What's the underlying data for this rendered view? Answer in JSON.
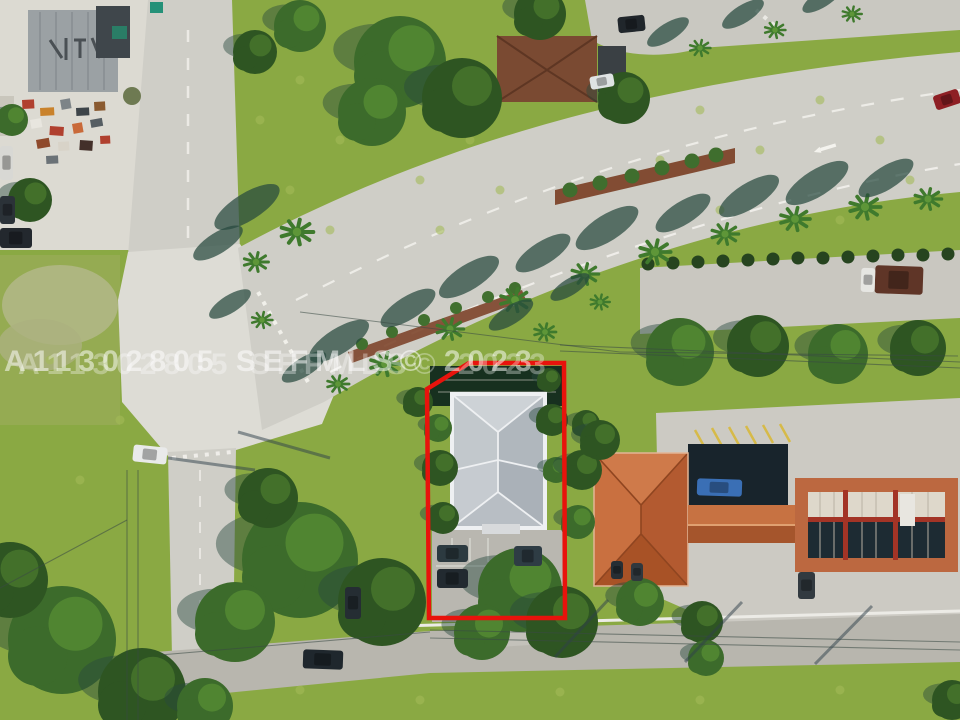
{
  "image": {
    "kind": "aerial-drone-photo",
    "subject": "real-estate parcel outlined in red at a palm-lined boulevard intersection"
  },
  "watermark": {
    "text": "A11302805 SEFMLS© 2023",
    "color": "rgba(255,255,255,0.52)",
    "ghost_color": "rgba(255,255,255,0.33)"
  },
  "property_outline": {
    "points": "427,389 469,363 564,363 565,618 429,618",
    "color": "#e8130c"
  },
  "colors": {
    "grass": "#8aa943",
    "grass_light": "#a3bb58",
    "road": "#cfcec7",
    "road_bottom": "#b8b6ae",
    "concrete": "#dcdad2",
    "house_roof": "#bcc2c7",
    "orange_roof": "#c06a3e",
    "dark_roof": "#18242c",
    "shadow": "#27493f",
    "mulch": "#7d452b",
    "canopy_dark": "#33592a"
  },
  "scene": {
    "palms": [
      {
        "x": 385,
        "y": 364,
        "s": 1.15
      },
      {
        "x": 450,
        "y": 329,
        "s": 1.05
      },
      {
        "x": 515,
        "y": 300,
        "s": 1.15
      },
      {
        "x": 585,
        "y": 274,
        "s": 1.05
      },
      {
        "x": 655,
        "y": 252,
        "s": 1.2
      },
      {
        "x": 725,
        "y": 234,
        "s": 1.05
      },
      {
        "x": 795,
        "y": 219,
        "s": 1.15
      },
      {
        "x": 865,
        "y": 207,
        "s": 1.2
      },
      {
        "x": 928,
        "y": 199,
        "s": 1.05
      },
      {
        "x": 700,
        "y": 48,
        "s": 0.8
      },
      {
        "x": 775,
        "y": 30,
        "s": 0.8
      },
      {
        "x": 852,
        "y": 14,
        "s": 0.75
      },
      {
        "x": 297,
        "y": 232,
        "s": 1.25
      },
      {
        "x": 256,
        "y": 262,
        "s": 0.95
      },
      {
        "x": 338,
        "y": 384,
        "s": 0.85
      },
      {
        "x": 545,
        "y": 332,
        "s": 0.85
      },
      {
        "x": 600,
        "y": 302,
        "s": 0.75
      },
      {
        "x": 262,
        "y": 320,
        "s": 0.8
      }
    ],
    "median_bushes": [
      {
        "x": 570,
        "y": 190
      },
      {
        "x": 600,
        "y": 183
      },
      {
        "x": 632,
        "y": 176
      },
      {
        "x": 662,
        "y": 168
      },
      {
        "x": 692,
        "y": 161
      },
      {
        "x": 716,
        "y": 155
      }
    ],
    "verge_bushes": [
      {
        "x": 362,
        "y": 344
      },
      {
        "x": 392,
        "y": 332
      },
      {
        "x": 424,
        "y": 320
      },
      {
        "x": 456,
        "y": 308
      },
      {
        "x": 488,
        "y": 297
      },
      {
        "x": 515,
        "y": 288
      }
    ],
    "hedge_row": [
      {
        "x": 648,
        "y": 264
      },
      {
        "x": 673,
        "y": 263
      },
      {
        "x": 698,
        "y": 262
      },
      {
        "x": 723,
        "y": 261
      },
      {
        "x": 748,
        "y": 260
      },
      {
        "x": 773,
        "y": 259
      },
      {
        "x": 798,
        "y": 258
      },
      {
        "x": 823,
        "y": 258
      },
      {
        "x": 848,
        "y": 257
      },
      {
        "x": 873,
        "y": 256
      },
      {
        "x": 898,
        "y": 255
      },
      {
        "x": 923,
        "y": 255
      },
      {
        "x": 948,
        "y": 254
      }
    ],
    "tree_clumps": [
      {
        "x": 400,
        "y": 62,
        "r": 46,
        "t": 0
      },
      {
        "x": 462,
        "y": 98,
        "r": 40,
        "t": 1
      },
      {
        "x": 372,
        "y": 112,
        "r": 34,
        "t": 0
      },
      {
        "x": 540,
        "y": 14,
        "r": 26,
        "t": 1
      },
      {
        "x": 624,
        "y": 98,
        "r": 26,
        "t": 1
      },
      {
        "x": 300,
        "y": 26,
        "r": 26,
        "t": 0
      },
      {
        "x": 255,
        "y": 52,
        "r": 22,
        "t": 1
      },
      {
        "x": 300,
        "y": 560,
        "r": 58,
        "t": 0
      },
      {
        "x": 382,
        "y": 602,
        "r": 44,
        "t": 1
      },
      {
        "x": 235,
        "y": 622,
        "r": 40,
        "t": 0
      },
      {
        "x": 268,
        "y": 498,
        "r": 30,
        "t": 1
      },
      {
        "x": 62,
        "y": 640,
        "r": 54,
        "t": 0
      },
      {
        "x": 142,
        "y": 692,
        "r": 44,
        "t": 1
      },
      {
        "x": 10,
        "y": 580,
        "r": 38,
        "t": 1
      },
      {
        "x": 205,
        "y": 706,
        "r": 28,
        "t": 0
      },
      {
        "x": 440,
        "y": 468,
        "r": 18,
        "t": 1
      },
      {
        "x": 438,
        "y": 428,
        "r": 14,
        "t": 0
      },
      {
        "x": 443,
        "y": 518,
        "r": 16,
        "t": 1
      },
      {
        "x": 552,
        "y": 420,
        "r": 16,
        "t": 1
      },
      {
        "x": 556,
        "y": 470,
        "r": 13,
        "t": 0
      },
      {
        "x": 549,
        "y": 380,
        "r": 12,
        "t": 1
      },
      {
        "x": 418,
        "y": 402,
        "r": 15,
        "t": 1
      },
      {
        "x": 520,
        "y": 590,
        "r": 42,
        "t": 0
      },
      {
        "x": 562,
        "y": 622,
        "r": 36,
        "t": 1
      },
      {
        "x": 482,
        "y": 632,
        "r": 28,
        "t": 0
      },
      {
        "x": 582,
        "y": 470,
        "r": 20,
        "t": 1
      },
      {
        "x": 578,
        "y": 522,
        "r": 17,
        "t": 0
      },
      {
        "x": 586,
        "y": 424,
        "r": 14,
        "t": 1
      },
      {
        "x": 680,
        "y": 352,
        "r": 34,
        "t": 0
      },
      {
        "x": 758,
        "y": 346,
        "r": 31,
        "t": 1
      },
      {
        "x": 838,
        "y": 354,
        "r": 30,
        "t": 0
      },
      {
        "x": 918,
        "y": 348,
        "r": 28,
        "t": 1
      },
      {
        "x": 600,
        "y": 440,
        "r": 20,
        "t": 1
      },
      {
        "x": 640,
        "y": 602,
        "r": 24,
        "t": 0
      },
      {
        "x": 702,
        "y": 622,
        "r": 21,
        "t": 1
      },
      {
        "x": 706,
        "y": 658,
        "r": 18,
        "t": 0
      },
      {
        "x": 952,
        "y": 700,
        "r": 20,
        "t": 1
      },
      {
        "x": 30,
        "y": 200,
        "r": 22,
        "t": 1
      },
      {
        "x": 12,
        "y": 120,
        "r": 16,
        "t": 0
      }
    ],
    "cars": [
      {
        "x": 618,
        "y": 16,
        "w": 27,
        "h": 16,
        "c": "#20262b",
        "rot": -6,
        "name": "suv-top"
      },
      {
        "x": 590,
        "y": 75,
        "w": 24,
        "h": 13,
        "c": "#dfe3e4",
        "rot": -10,
        "name": "white-vehicle-house"
      },
      {
        "x": 934,
        "y": 92,
        "w": 26,
        "h": 15,
        "c": "#8e1f24",
        "rot": -18,
        "name": "red-car"
      },
      {
        "x": 133,
        "y": 446,
        "w": 34,
        "h": 17,
        "c": "#e9eaea",
        "rot": 6,
        "name": "white-car-intersection"
      },
      {
        "x": 875,
        "y": 266,
        "w": 48,
        "h": 28,
        "c": "#5f3527",
        "rot": 2,
        "name": "truck-trailer"
      },
      {
        "x": 861,
        "y": 268,
        "w": 14,
        "h": 24,
        "c": "#e6e6e2",
        "rot": 2,
        "name": "truck-cab"
      },
      {
        "x": 697,
        "y": 479,
        "w": 45,
        "h": 17,
        "c": "#3a6fb5",
        "rot": 2,
        "name": "blue-pickup"
      },
      {
        "x": 798,
        "y": 572,
        "w": 17,
        "h": 27,
        "c": "#323a40",
        "rot": 0,
        "name": "gray-car-canopy"
      },
      {
        "x": 611,
        "y": 561,
        "w": 12,
        "h": 18,
        "c": "#262e34",
        "rot": 0,
        "name": "dark-car-lot-a"
      },
      {
        "x": 631,
        "y": 563,
        "w": 12,
        "h": 18,
        "c": "#30383e",
        "rot": 0,
        "name": "dark-car-lot-b"
      },
      {
        "x": 437,
        "y": 545,
        "w": 31,
        "h": 17,
        "c": "#2c3a40",
        "rot": 0,
        "name": "parked-car-1"
      },
      {
        "x": 437,
        "y": 569,
        "w": 31,
        "h": 19,
        "c": "#222a30",
        "rot": 0,
        "name": "parked-car-2"
      },
      {
        "x": 514,
        "y": 546,
        "w": 28,
        "h": 20,
        "c": "#2e3c44",
        "rot": 0,
        "name": "parked-car-3"
      },
      {
        "x": 345,
        "y": 587,
        "w": 16,
        "h": 32,
        "c": "#252d33",
        "rot": 0,
        "name": "street-car-west"
      },
      {
        "x": 303,
        "y": 650,
        "w": 40,
        "h": 19,
        "c": "#1f272d",
        "rot": 2,
        "name": "car-bottom-road"
      },
      {
        "x": 0,
        "y": 146,
        "w": 13,
        "h": 34,
        "c": "#d8d8d4",
        "rot": 0,
        "name": "white-van-yard"
      },
      {
        "x": 0,
        "y": 196,
        "w": 15,
        "h": 28,
        "c": "#2b3238",
        "rot": 0,
        "name": "dark-car-yard"
      },
      {
        "x": 0,
        "y": 228,
        "w": 32,
        "h": 20,
        "c": "#23282e",
        "rot": 0,
        "name": "truck-yard"
      }
    ],
    "junk": [
      {
        "x": 22,
        "y": 100,
        "w": 12,
        "h": 9,
        "c": "#b0402f"
      },
      {
        "x": 40,
        "y": 108,
        "w": 14,
        "h": 8,
        "c": "#c9822c"
      },
      {
        "x": 60,
        "y": 100,
        "w": 10,
        "h": 10,
        "c": "#7d8488"
      },
      {
        "x": 76,
        "y": 108,
        "w": 13,
        "h": 8,
        "c": "#3d4449"
      },
      {
        "x": 94,
        "y": 102,
        "w": 11,
        "h": 9,
        "c": "#8a5a30"
      },
      {
        "x": 30,
        "y": 120,
        "w": 11,
        "h": 9,
        "c": "#e8e6df"
      },
      {
        "x": 50,
        "y": 126,
        "w": 14,
        "h": 9,
        "c": "#b0402f"
      },
      {
        "x": 72,
        "y": 124,
        "w": 10,
        "h": 10,
        "c": "#c96a3a"
      },
      {
        "x": 90,
        "y": 120,
        "w": 12,
        "h": 8,
        "c": "#565e63"
      },
      {
        "x": 36,
        "y": 140,
        "w": 13,
        "h": 9,
        "c": "#8f4a2c"
      },
      {
        "x": 58,
        "y": 142,
        "w": 11,
        "h": 9,
        "c": "#d8d3c8"
      },
      {
        "x": 80,
        "y": 140,
        "w": 13,
        "h": 10,
        "c": "#43302a"
      },
      {
        "x": 100,
        "y": 136,
        "w": 10,
        "h": 8,
        "c": "#b0402f"
      },
      {
        "x": 46,
        "y": 156,
        "w": 12,
        "h": 8,
        "c": "#6b7277"
      }
    ],
    "speckles": [
      {
        "x": 300,
        "y": 80
      },
      {
        "x": 340,
        "y": 140
      },
      {
        "x": 290,
        "y": 190
      },
      {
        "x": 420,
        "y": 180
      },
      {
        "x": 470,
        "y": 140
      },
      {
        "x": 360,
        "y": 60
      },
      {
        "x": 440,
        "y": 230
      },
      {
        "x": 500,
        "y": 190
      },
      {
        "x": 330,
        "y": 230
      },
      {
        "x": 260,
        "y": 120
      },
      {
        "x": 700,
        "y": 110
      },
      {
        "x": 760,
        "y": 150
      },
      {
        "x": 820,
        "y": 100
      },
      {
        "x": 880,
        "y": 140
      },
      {
        "x": 720,
        "y": 210
      },
      {
        "x": 840,
        "y": 220
      },
      {
        "x": 910,
        "y": 180
      },
      {
        "x": 660,
        "y": 160
      },
      {
        "x": 300,
        "y": 690
      },
      {
        "x": 420,
        "y": 700
      },
      {
        "x": 560,
        "y": 692
      },
      {
        "x": 700,
        "y": 700
      },
      {
        "x": 840,
        "y": 690
      },
      {
        "x": 120,
        "y": 420
      },
      {
        "x": 80,
        "y": 480
      },
      {
        "x": 50,
        "y": 360
      }
    ],
    "wires": [
      {
        "x1": 430,
        "y1": 630,
        "x2": 960,
        "y2": 642
      },
      {
        "x1": 430,
        "y1": 638,
        "x2": 960,
        "y2": 650
      },
      {
        "x1": 160,
        "y1": 655,
        "x2": 430,
        "y2": 632
      },
      {
        "x1": 127,
        "y1": 470,
        "x2": 127,
        "y2": 720
      },
      {
        "x1": 138,
        "y1": 470,
        "x2": 138,
        "y2": 720
      },
      {
        "x1": 0,
        "y1": 588,
        "x2": 127,
        "y2": 520
      },
      {
        "x1": 560,
        "y1": 345,
        "x2": 960,
        "y2": 362
      },
      {
        "x1": 560,
        "y1": 351,
        "x2": 960,
        "y2": 368
      },
      {
        "x1": 300,
        "y1": 312,
        "x2": 620,
        "y2": 352
      },
      {
        "x1": 620,
        "y1": 352,
        "x2": 958,
        "y2": 356
      }
    ],
    "pole_shadows": [
      {
        "x1": 555,
        "y1": 657,
        "x2": 608,
        "y2": 600
      },
      {
        "x1": 685,
        "y1": 662,
        "x2": 742,
        "y2": 602
      },
      {
        "x1": 815,
        "y1": 664,
        "x2": 872,
        "y2": 606
      },
      {
        "x1": 238,
        "y1": 432,
        "x2": 330,
        "y2": 458
      },
      {
        "x1": 168,
        "y1": 458,
        "x2": 255,
        "y2": 470
      }
    ]
  }
}
